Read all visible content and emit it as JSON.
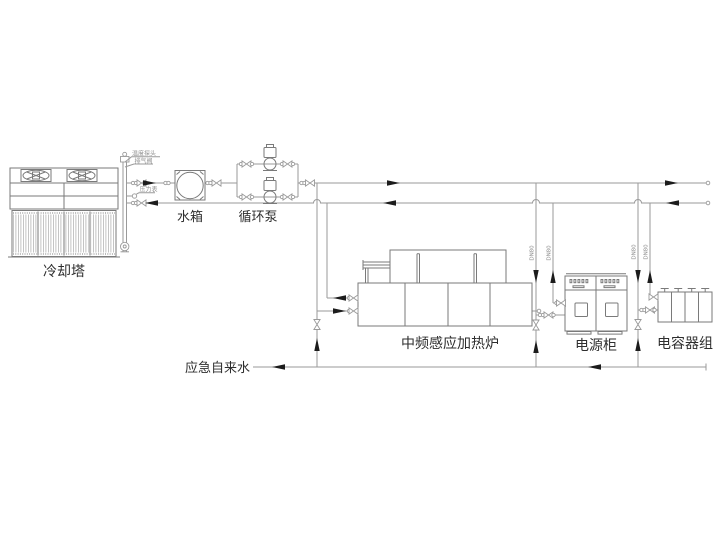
{
  "diagram": {
    "labels": {
      "cooling_tower": "冷却塔",
      "water_tank": "水箱",
      "circulation_pump": "循环泵",
      "furnace": "中频感应加热炉",
      "power_cabinet": "电源柜",
      "capacitor_bank": "电容器组",
      "emergency_water": "应急自来水",
      "temp_probe": "温度探头",
      "air_vent": "排气阀",
      "pressure_gauge": "压力表",
      "pipe_size": "DN80"
    },
    "colors": {
      "pipe": "#9a9a9a",
      "equipment": "#7a7a7a",
      "arrow": "#1c1c1c",
      "text": "#2e2e2e",
      "small_text": "#8c8c8c",
      "background": "#ffffff"
    }
  }
}
